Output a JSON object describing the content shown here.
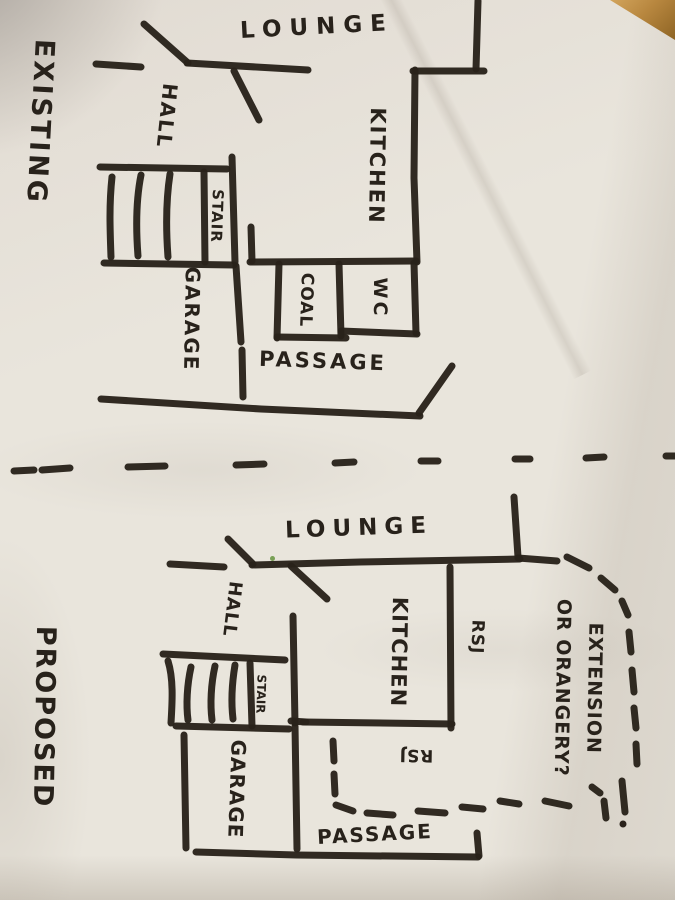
{
  "colors": {
    "paper": "#e9e5dc",
    "ink": "#29221a",
    "table_wood": "#b8873f"
  },
  "existing_plan": {
    "title": "EXISTING",
    "labels": {
      "lounge": "LOUNGE",
      "hall": "HALL",
      "kitchen": "KITCHEN",
      "stair": "STAIR",
      "garage": "GARAGE",
      "coal": "COAL",
      "wc": "WC",
      "passage": "PASSAGE"
    }
  },
  "proposed_plan": {
    "title": "PROPOSED",
    "labels": {
      "lounge": "LOUNGE",
      "hall": "HALL",
      "kitchen": "KITCHEN",
      "stair": "STAIR",
      "garage": "GARAGE",
      "passage": "PASSAGE"
    },
    "annotations": {
      "rsj_right": "RSJ",
      "rsj_bottom": "RSJ",
      "extension_line1": "EXTENSION",
      "extension_line2": "OR ORANGERY?"
    }
  }
}
